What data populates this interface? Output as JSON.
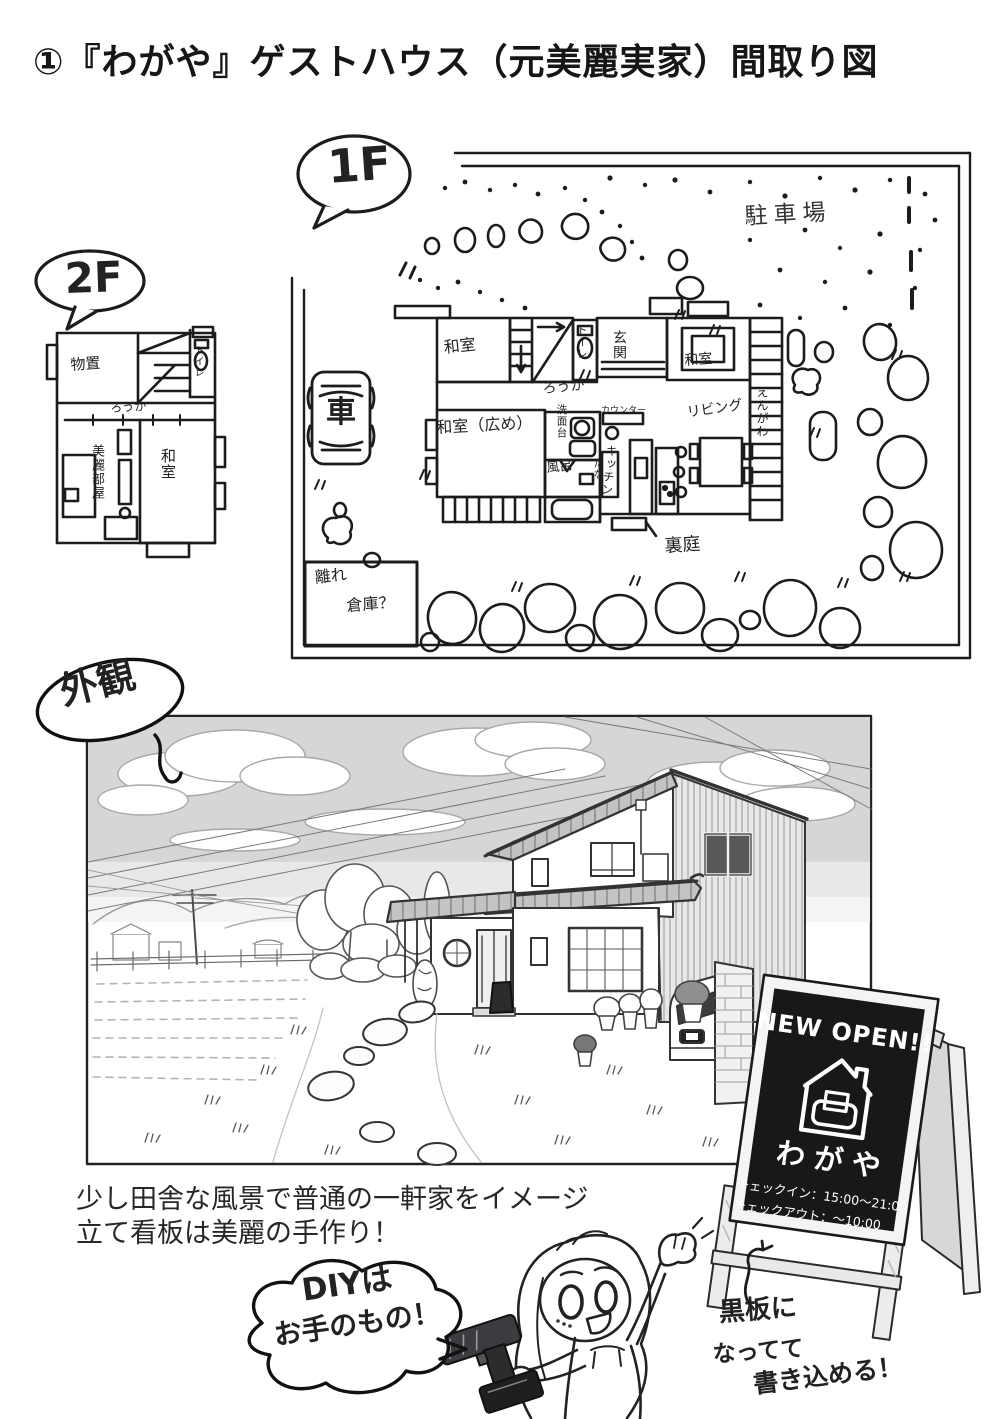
{
  "title": "①『わがや』ゲストハウス（元美麗実家）間取り図",
  "floor1": {
    "bubble": "1F",
    "labels": {
      "parking": "駐車場",
      "car": "車",
      "washitsu_tl": "和室",
      "toilet": "トイレ",
      "genkan": "玄関",
      "washitsu_r": "和室",
      "engawa": "えんがわ",
      "rouka": "ろうか",
      "washitsu_large": "和室（広め）",
      "senmendai": "洗面台",
      "counter": "カウンター",
      "living": "リビング",
      "kitchen": "キッチン",
      "tana": "たな",
      "bath": "風呂",
      "backyard": "裏庭",
      "shed_line1": "離れ",
      "shed_line2": "倉庫？"
    }
  },
  "floor2": {
    "bubble": "2F",
    "labels": {
      "storage": "物置",
      "toilet": "トイレ",
      "rouka": "ろうか",
      "birei_room": "美麗部屋",
      "washitsu": "和室"
    }
  },
  "exterior": {
    "bubble": "外観"
  },
  "sign": {
    "new_open": "NEW OPEN!!",
    "name": "わがや",
    "checkin": "チェックイン：15:00〜21:00",
    "checkout": "チェックアウト：〜10:00"
  },
  "caption": {
    "line1": "少し田舎な風景で普通の一軒家をイメージ",
    "line2": "立て看板は美麗の手作り！"
  },
  "speech": {
    "line1": "DIYは",
    "line2": "お手のもの！"
  },
  "note": {
    "line1": "黒板に",
    "line2": "なってて",
    "line3": "書き込める！"
  },
  "colors": {
    "ink": "#1c1c1c",
    "board": "#17171a",
    "sky_tone": "#d4d4d4"
  }
}
